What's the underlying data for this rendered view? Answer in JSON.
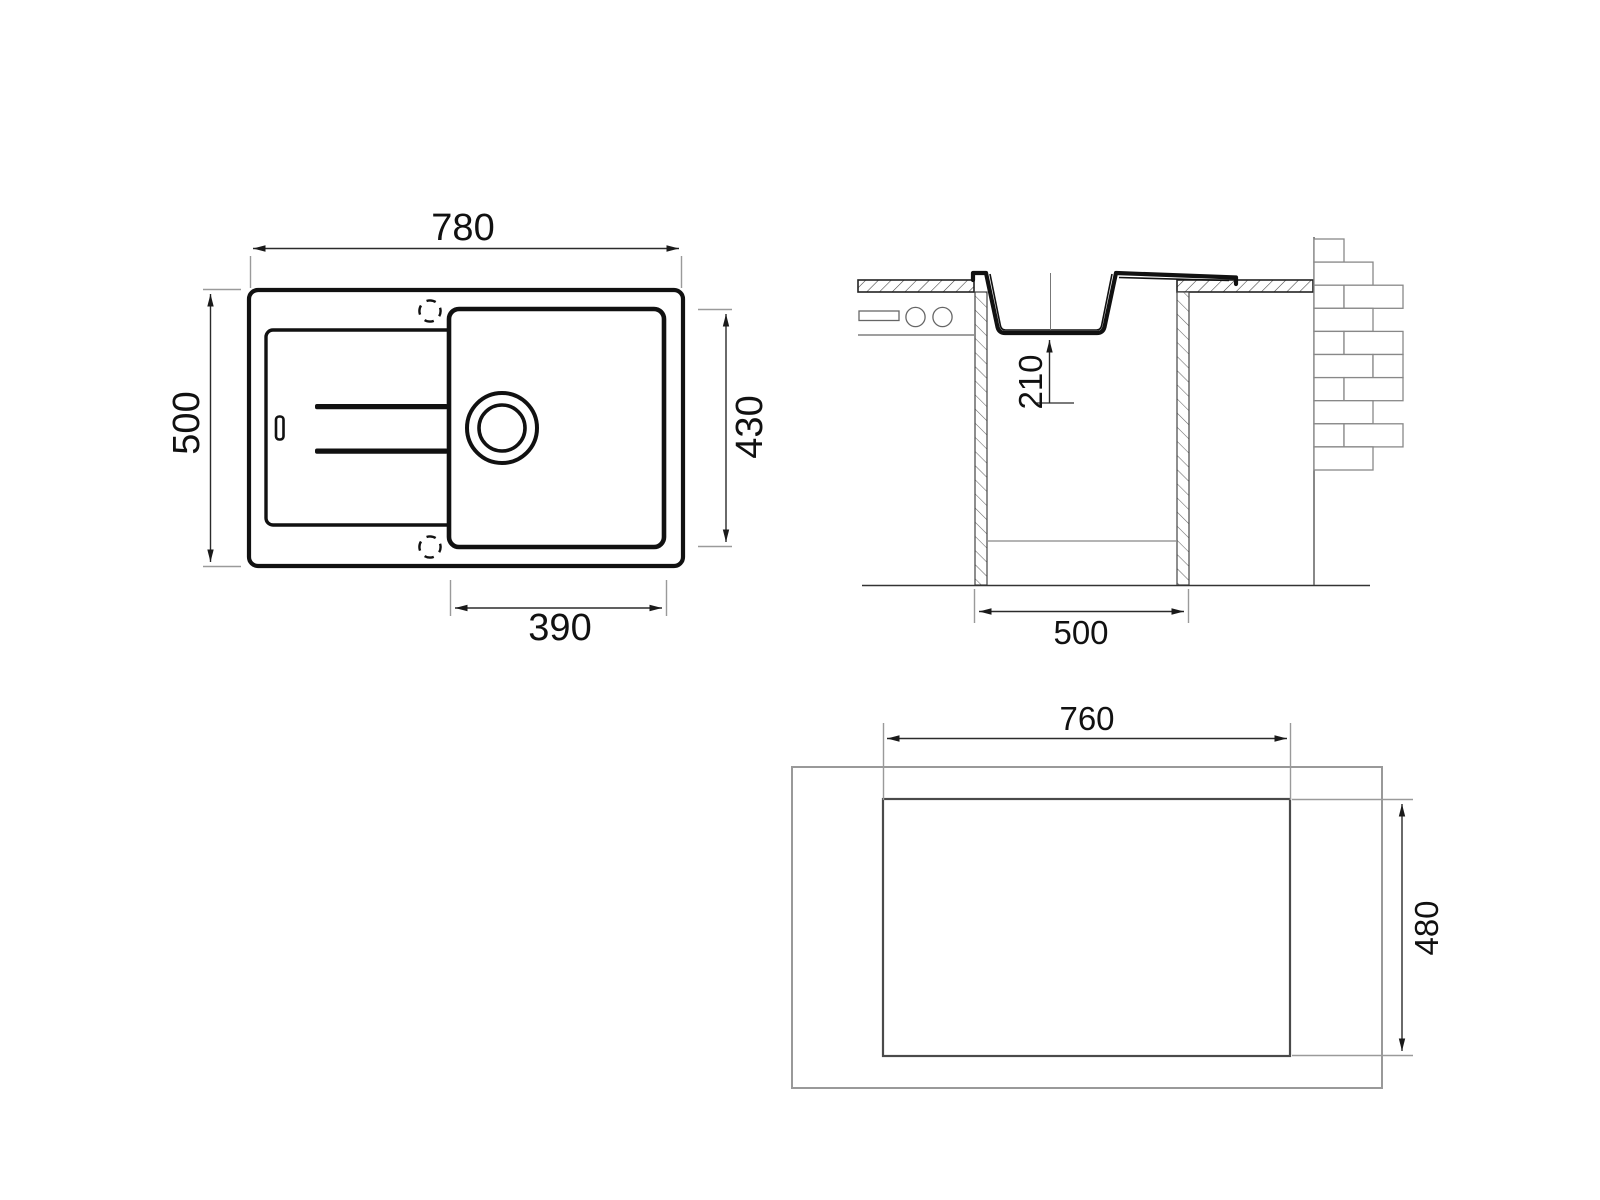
{
  "views": {
    "plan": {
      "dimensions": {
        "overall_width": "780",
        "overall_depth": "500",
        "bowl_length": "430",
        "bowl_width": "390"
      }
    },
    "section": {
      "dimensions": {
        "bowl_depth": "210",
        "base_cabinet_width": "500"
      }
    },
    "cutout": {
      "dimensions": {
        "cutout_width": "760",
        "cutout_height": "480"
      }
    }
  },
  "colors": {
    "line": "#111111",
    "dimension_line": "#2b2b2b",
    "extension_line": "#9a9a9a",
    "light_line": "#777777",
    "background": "#ffffff"
  }
}
